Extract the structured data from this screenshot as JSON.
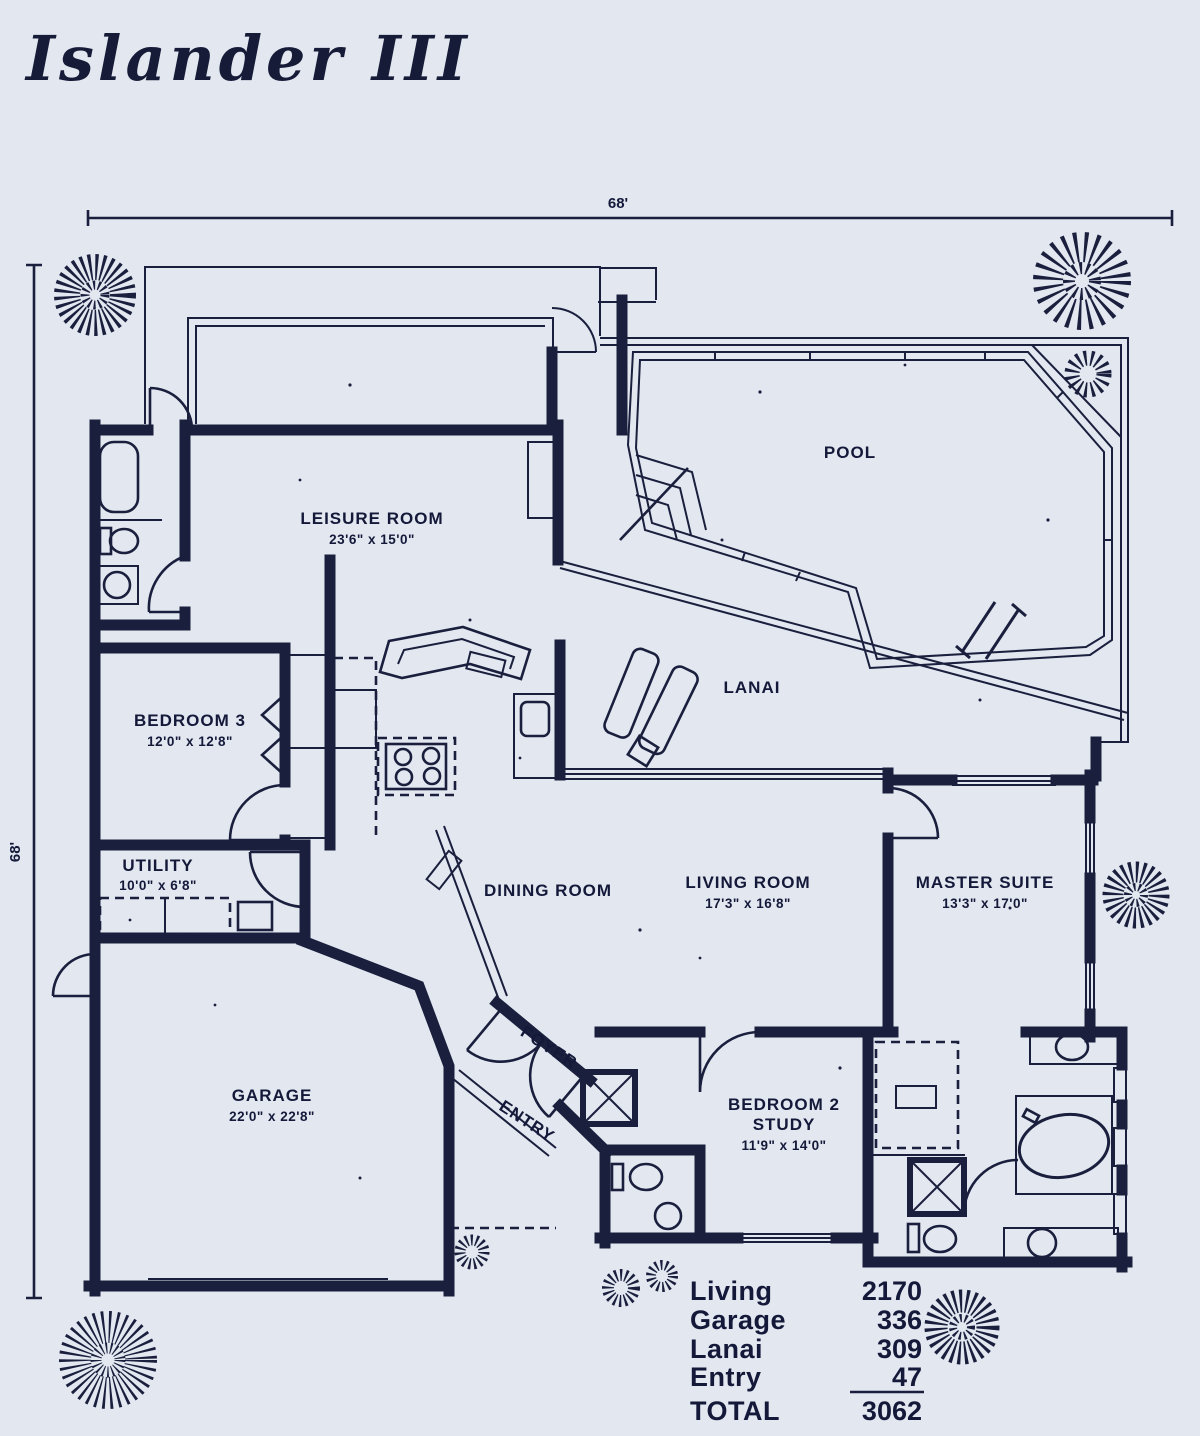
{
  "title": "Islander III",
  "colors": {
    "background": "#e3e7f0",
    "ink": "#1a1f3d"
  },
  "dimensions": {
    "top": "68'",
    "left": "68'"
  },
  "rooms": {
    "leisure": {
      "label": "LEISURE ROOM",
      "dims": "23'6\" x 15'0\""
    },
    "pool": {
      "label": "POOL"
    },
    "lanai": {
      "label": "LANAI"
    },
    "bedroom3": {
      "label": "BEDROOM 3",
      "dims": "12'0\" x 12'8\""
    },
    "utility": {
      "label": "UTILITY",
      "dims": "10'0\" x 6'8\""
    },
    "dining": {
      "label": "DINING ROOM"
    },
    "living": {
      "label": "LIVING ROOM",
      "dims": "17'3\" x 16'8\""
    },
    "master": {
      "label": "MASTER SUITE",
      "dims": "13'3\" x 17'0\""
    },
    "garage": {
      "label": "GARAGE",
      "dims": "22'0\" x 22'8\""
    },
    "foyer": {
      "label": "FOYER"
    },
    "entry": {
      "label": "ENTRY"
    },
    "bedroom2": {
      "label": "BEDROOM 2",
      "label2": "STUDY",
      "dims": "11'9\" x 14'0\""
    }
  },
  "area_table": {
    "rows": [
      {
        "label": "Living",
        "value": "2170"
      },
      {
        "label": "Garage",
        "value": "336"
      },
      {
        "label": "Lanai",
        "value": "309"
      },
      {
        "label": "Entry",
        "value": "47"
      }
    ],
    "total_label": "TOTAL",
    "total_value": "3062"
  }
}
